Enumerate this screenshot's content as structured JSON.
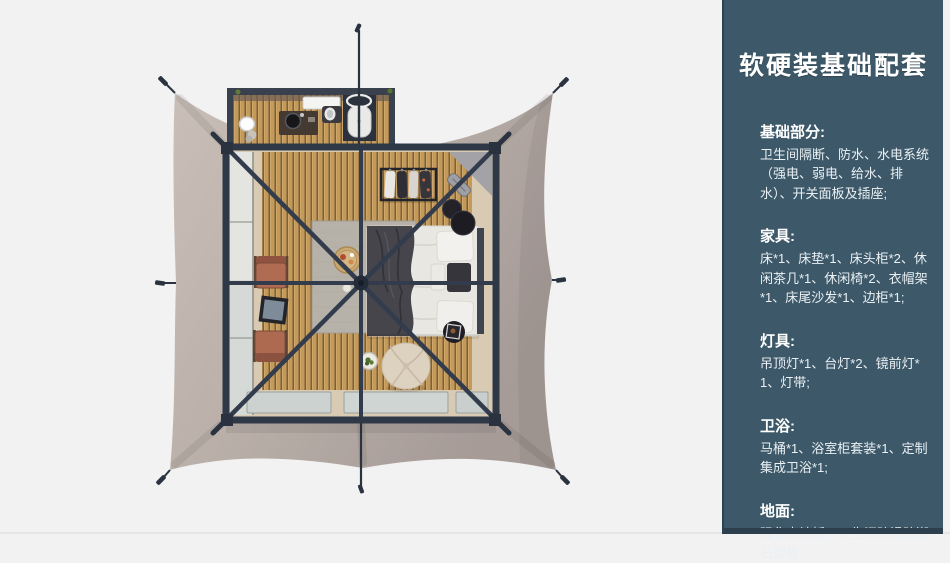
{
  "sidebar": {
    "title": "软硬装基础配套",
    "sections": [
      {
        "heading": "基础部分:",
        "body": "卫生间隔断、防水、水电系统（强电、弱电、给水、排水）、开关面板及插座;"
      },
      {
        "heading": "家具:",
        "body": "床*1、床垫*1、床头柜*2、休闲茶几*1、休闲椅*2、衣帽架*1、床尾沙发*1、边柜*1;"
      },
      {
        "heading": "灯具:",
        "body": "吊顶灯*1、台灯*2、镜前灯*1、灯带;"
      },
      {
        "heading": "卫浴:",
        "body": "马桶*1、浴室柜套装*1、定制集成卫浴*1;"
      },
      {
        "heading": "地面:",
        "body": "强化木地板、卫生间防滑防潮石塑板;"
      }
    ],
    "colors": {
      "background": "#3d5969",
      "text": "#eef2f5",
      "bottom_strip": "#2d3f4d"
    }
  },
  "scene": {
    "kind": "top-down-render-of-safari-tent-guest-room",
    "colors": {
      "page_background": "#f2f2f3",
      "tent_canvas": "#b9afa8",
      "frame": "#2f3847",
      "wood_floor": "#c59a58",
      "rug": "#b7b2a9",
      "bedding": "#e9e7e2",
      "throw_blanket": "#45454b",
      "chairs": "#b06c52"
    }
  }
}
